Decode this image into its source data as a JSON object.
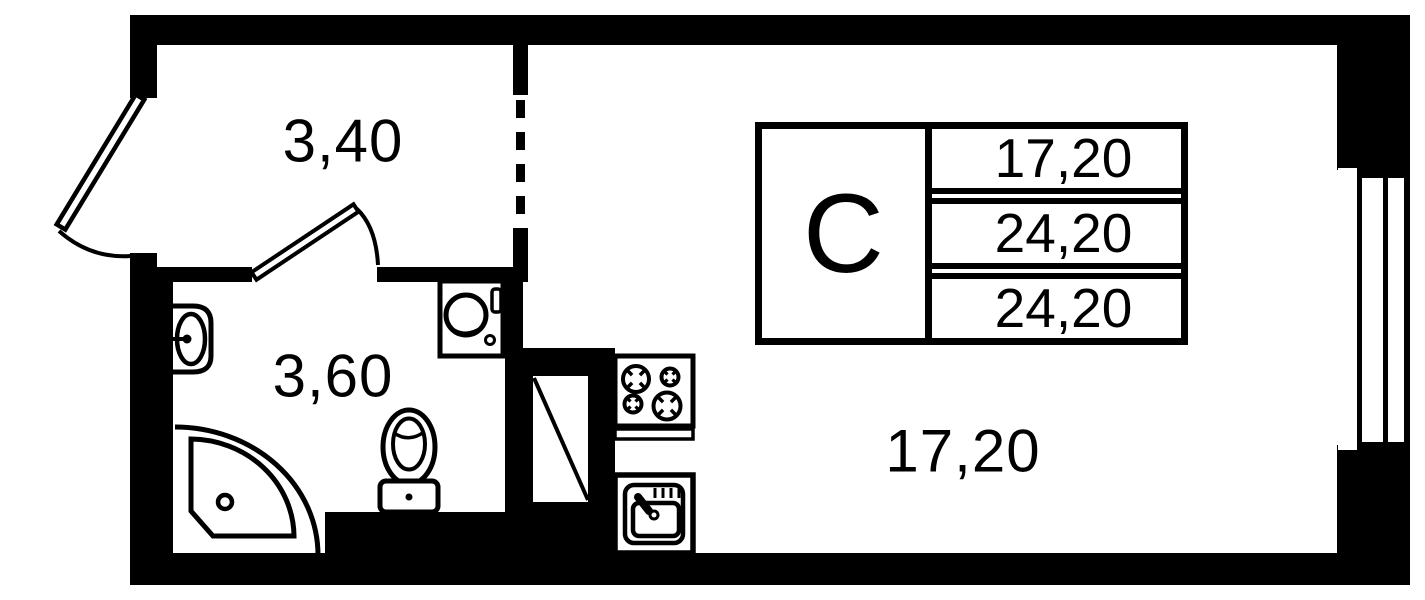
{
  "document": {
    "kind": "studio apartment floor plan",
    "background_color": "#ffffff",
    "ink_color": "#000000"
  },
  "rooms": {
    "hallway": {
      "area_label": "3,40"
    },
    "bathroom": {
      "area_label": "3,60"
    },
    "living_room": {
      "area_label": "17,20"
    }
  },
  "stamp": {
    "unit_type": "С",
    "rows": [
      "17,20",
      "24,20",
      "24,20"
    ]
  },
  "fixtures": [
    "entrance-door",
    "interior-door",
    "bathroom-sink",
    "shower-cabin",
    "toilet",
    "washing-machine",
    "ventilation-shaft",
    "stove",
    "kitchen-sink",
    "window",
    "virtual-partition-dashed"
  ]
}
